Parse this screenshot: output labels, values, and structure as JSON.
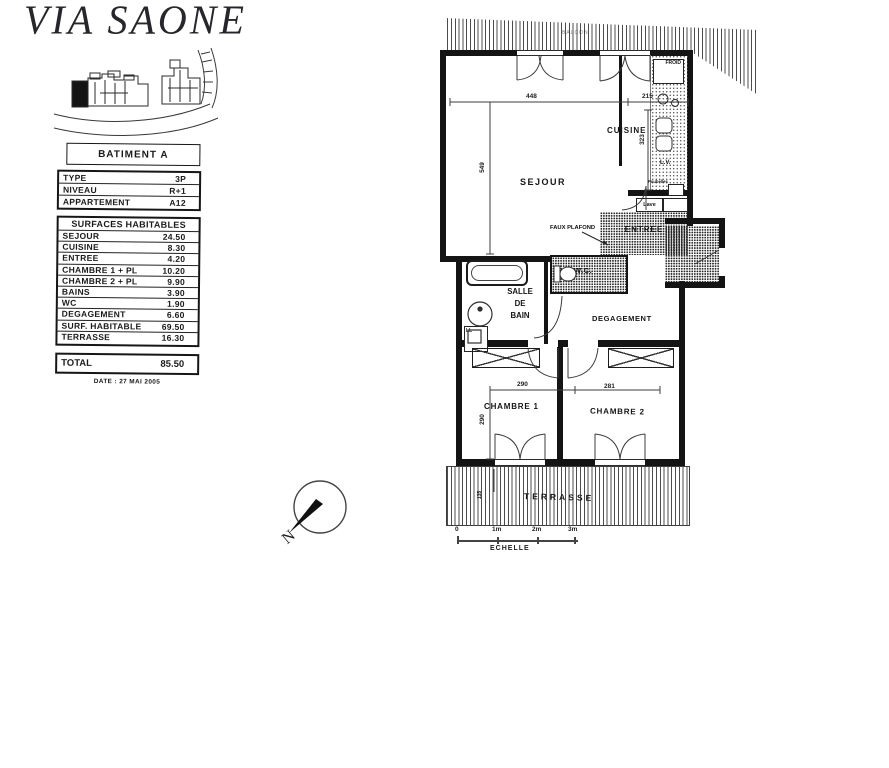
{
  "header": {
    "title": "VIA SAONE"
  },
  "building": {
    "label": "BATIMENT A"
  },
  "info": {
    "rows": [
      {
        "label": "TYPE",
        "value": "3P"
      },
      {
        "label": "NIVEAU",
        "value": "R+1"
      },
      {
        "label": "APPARTEMENT",
        "value": "A12"
      }
    ]
  },
  "surfaces": {
    "header": "SURFACES HABITABLES",
    "rows": [
      {
        "label": "SEJOUR",
        "value": "24.50"
      },
      {
        "label": "CUISINE",
        "value": "8.30"
      },
      {
        "label": "ENTREE",
        "value": "4.20"
      },
      {
        "label": "CHAMBRE 1 + PL",
        "value": "10.20"
      },
      {
        "label": "CHAMBRE 2 + PL",
        "value": "9.90"
      },
      {
        "label": "BAINS",
        "value": "3.90"
      },
      {
        "label": "WC",
        "value": "1.90"
      },
      {
        "label": "DEGAGEMENT",
        "value": "6.60"
      },
      {
        "label": "SURF. HABITABLE",
        "value": "69.50"
      },
      {
        "label": "TERRASSE",
        "value": "16.30"
      }
    ],
    "total": {
      "label": "TOTAL",
      "value": "85.50"
    }
  },
  "date": "DATE : 27 MAI 2005",
  "plan": {
    "rooms": {
      "sejour": "SEJOUR",
      "cuisine": "CUISINE",
      "entree": "ENTREE",
      "wc": "W.C.",
      "bath": "SALLE\nDE\nBAIN",
      "degagement": "DEGAGEMENT",
      "chambre1": "CHAMBRE 1",
      "chambre2": "CHAMBRE 2",
      "terrasse": "TERRASSE",
      "balcon": "BALCON"
    },
    "annotations": {
      "faux_plafond": "FAUX PLAFOND"
    },
    "fixtures": {
      "fridge": "FROID",
      "dishwasher": "L.V.",
      "washer": "Lave",
      "bins": "Poubelles",
      "laundry": "LL"
    },
    "dimensions": {
      "sejour_w": "448",
      "cuisine_w": "215",
      "sejour_h": "549",
      "cuisine_h": "323",
      "ch1_w": "290",
      "ch2_w": "281",
      "ch1_h": "290",
      "terrasse_d": "135"
    },
    "scale": {
      "t0": "0",
      "t1": "1m",
      "t2": "2m",
      "t3": "3m",
      "label": "ECHELLE"
    },
    "compass": {
      "north": "N"
    }
  }
}
